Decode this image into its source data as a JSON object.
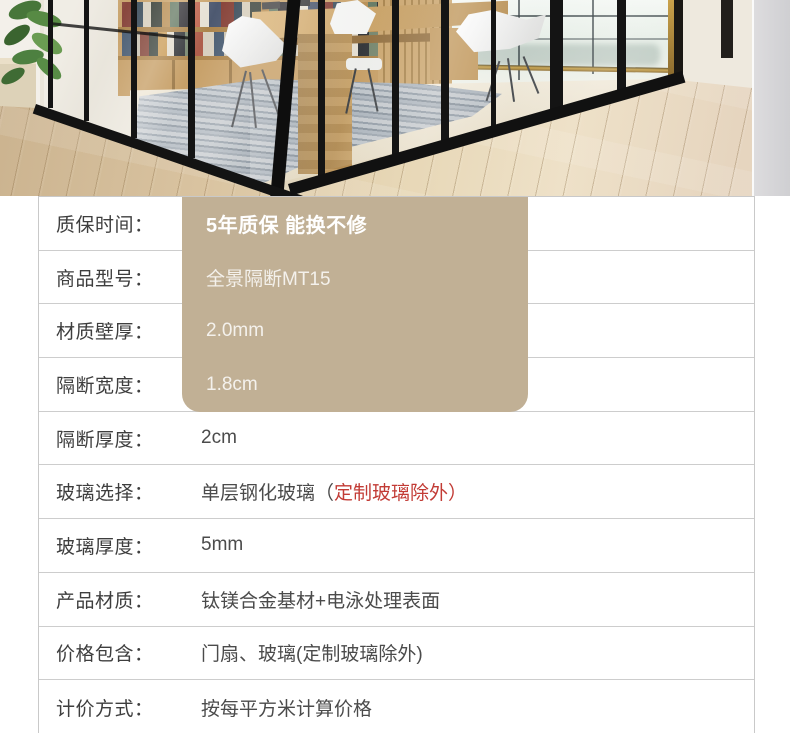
{
  "photo": {
    "alt": "黑框玻璃隔断样板间：书架、白色座椅、木桌、灰色地毯与木地板"
  },
  "colors": {
    "highlight_box": "#c1b095",
    "accent_red": "#c23b35",
    "label_text": "#3e3e3e",
    "value_text": "#4b4b4b",
    "divider": "#cdcdcd",
    "frame_black": "#141414"
  },
  "spec_table": {
    "rows": [
      {
        "label": "质保时间：",
        "value": "5年质保 能换不修"
      },
      {
        "label": "商品型号：",
        "value": "全景隔断MT15"
      },
      {
        "label": "材质壁厚：",
        "value": "2.0mm"
      },
      {
        "label": "隔断宽度：",
        "value": "1.8cm"
      },
      {
        "label": "隔断厚度：",
        "value": "2cm"
      },
      {
        "label": "玻璃选择：",
        "value_main": "单层钢化玻璃（",
        "value_red": "定制玻璃除外）"
      },
      {
        "label": "玻璃厚度：",
        "value": "5mm"
      },
      {
        "label": "产品材质：",
        "value": "钛镁合金基材+电泳处理表面"
      },
      {
        "label": "价格包含：",
        "value": "门扇、玻璃(定制玻璃除外)"
      },
      {
        "label": "计价方式：",
        "value": "按每平方米计算价格"
      }
    ]
  }
}
